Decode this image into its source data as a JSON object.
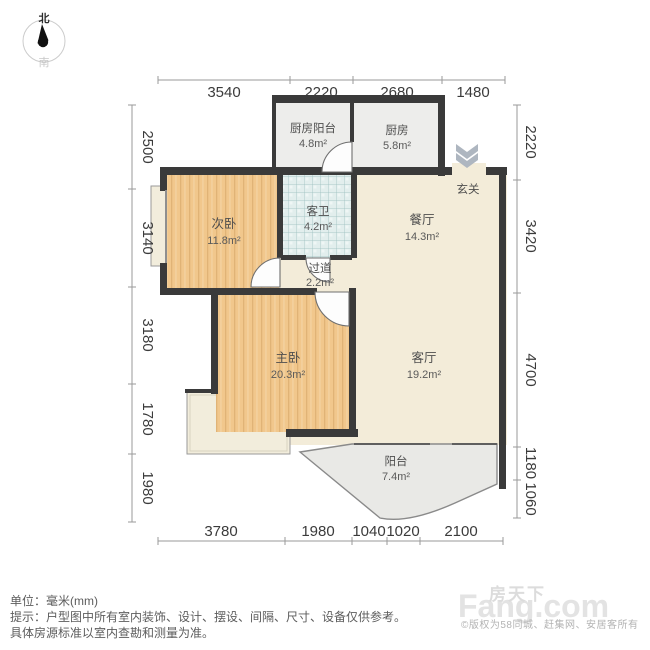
{
  "compass": {
    "north": "北",
    "south": "南"
  },
  "plan": {
    "rooms": [
      {
        "id": "kitchen-balcony",
        "name": "厨房阳台",
        "area": "4.8m²"
      },
      {
        "id": "kitchen",
        "name": "厨房",
        "area": "5.8m²"
      },
      {
        "id": "entry",
        "name": "玄关",
        "area": ""
      },
      {
        "id": "second-bedroom",
        "name": "次卧",
        "area": "11.8m²"
      },
      {
        "id": "bathroom",
        "name": "客卫",
        "area": "4.2m²"
      },
      {
        "id": "corridor",
        "name": "过道",
        "area": "2.2m²"
      },
      {
        "id": "dining",
        "name": "餐厅",
        "area": "14.3m²"
      },
      {
        "id": "master-bedroom",
        "name": "主卧",
        "area": "20.3m²"
      },
      {
        "id": "living",
        "name": "客厅",
        "area": "19.2m²"
      },
      {
        "id": "balcony",
        "name": "阳台",
        "area": "7.4m²"
      }
    ],
    "dimensions": {
      "top": [
        "3540",
        "2220",
        "2680",
        "1480"
      ],
      "bottom": [
        "3780",
        "1980",
        "1040",
        "1020",
        "2100"
      ],
      "left": [
        "2500",
        "3140",
        "3180",
        "1780",
        "1980"
      ],
      "right": [
        "2220",
        "3420",
        "4700",
        "1180",
        "1060"
      ]
    }
  },
  "notes": {
    "unit": "单位：毫米(mm)",
    "tip1": "提示：户型图中所有室内装饰、设计、摆设、间隔、尺寸、设备仅供参考。",
    "tip2": "具体房源标准以室内查勘和测量为准。"
  },
  "watermark": {
    "brand_cn": "房天下",
    "brand_en": "Fang.com",
    "copyright": "©版权为58同城、赶集网、安居客所有"
  },
  "colors": {
    "wall": "#3a3a3a",
    "wood_floor": "#f1c78c",
    "tile_floor": "#e2eeed",
    "cream_floor": "#f3ecd9",
    "gray_floor": "#ededeb",
    "balcony_floor": "#e9e9e6"
  }
}
